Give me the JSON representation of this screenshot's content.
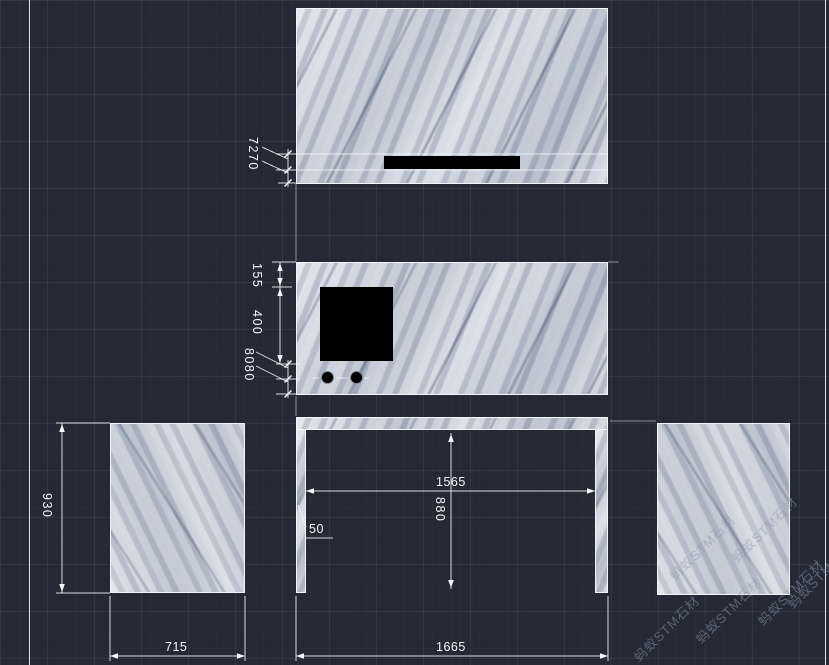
{
  "app": {
    "type": "cad-stone-layout-viewport",
    "background_color": "#232935",
    "grid_color": "#2d3542",
    "line_color": "#eef2f6",
    "marble_color": "#c3cad6",
    "cutout_color": "#000000",
    "watermark_color": "#8b98af"
  },
  "watermark": {
    "text": "蚂蚁STM石材"
  },
  "dimensions": {
    "top_bands": "7270",
    "mid_top_offset": "155",
    "mid_cutout_height": "400",
    "mid_bands": "8080",
    "left_panel_height": "930",
    "left_panel_width": "715",
    "opening_width": "1565",
    "opening_height": "880",
    "leg_width": "50",
    "frame_total_width": "1665"
  }
}
